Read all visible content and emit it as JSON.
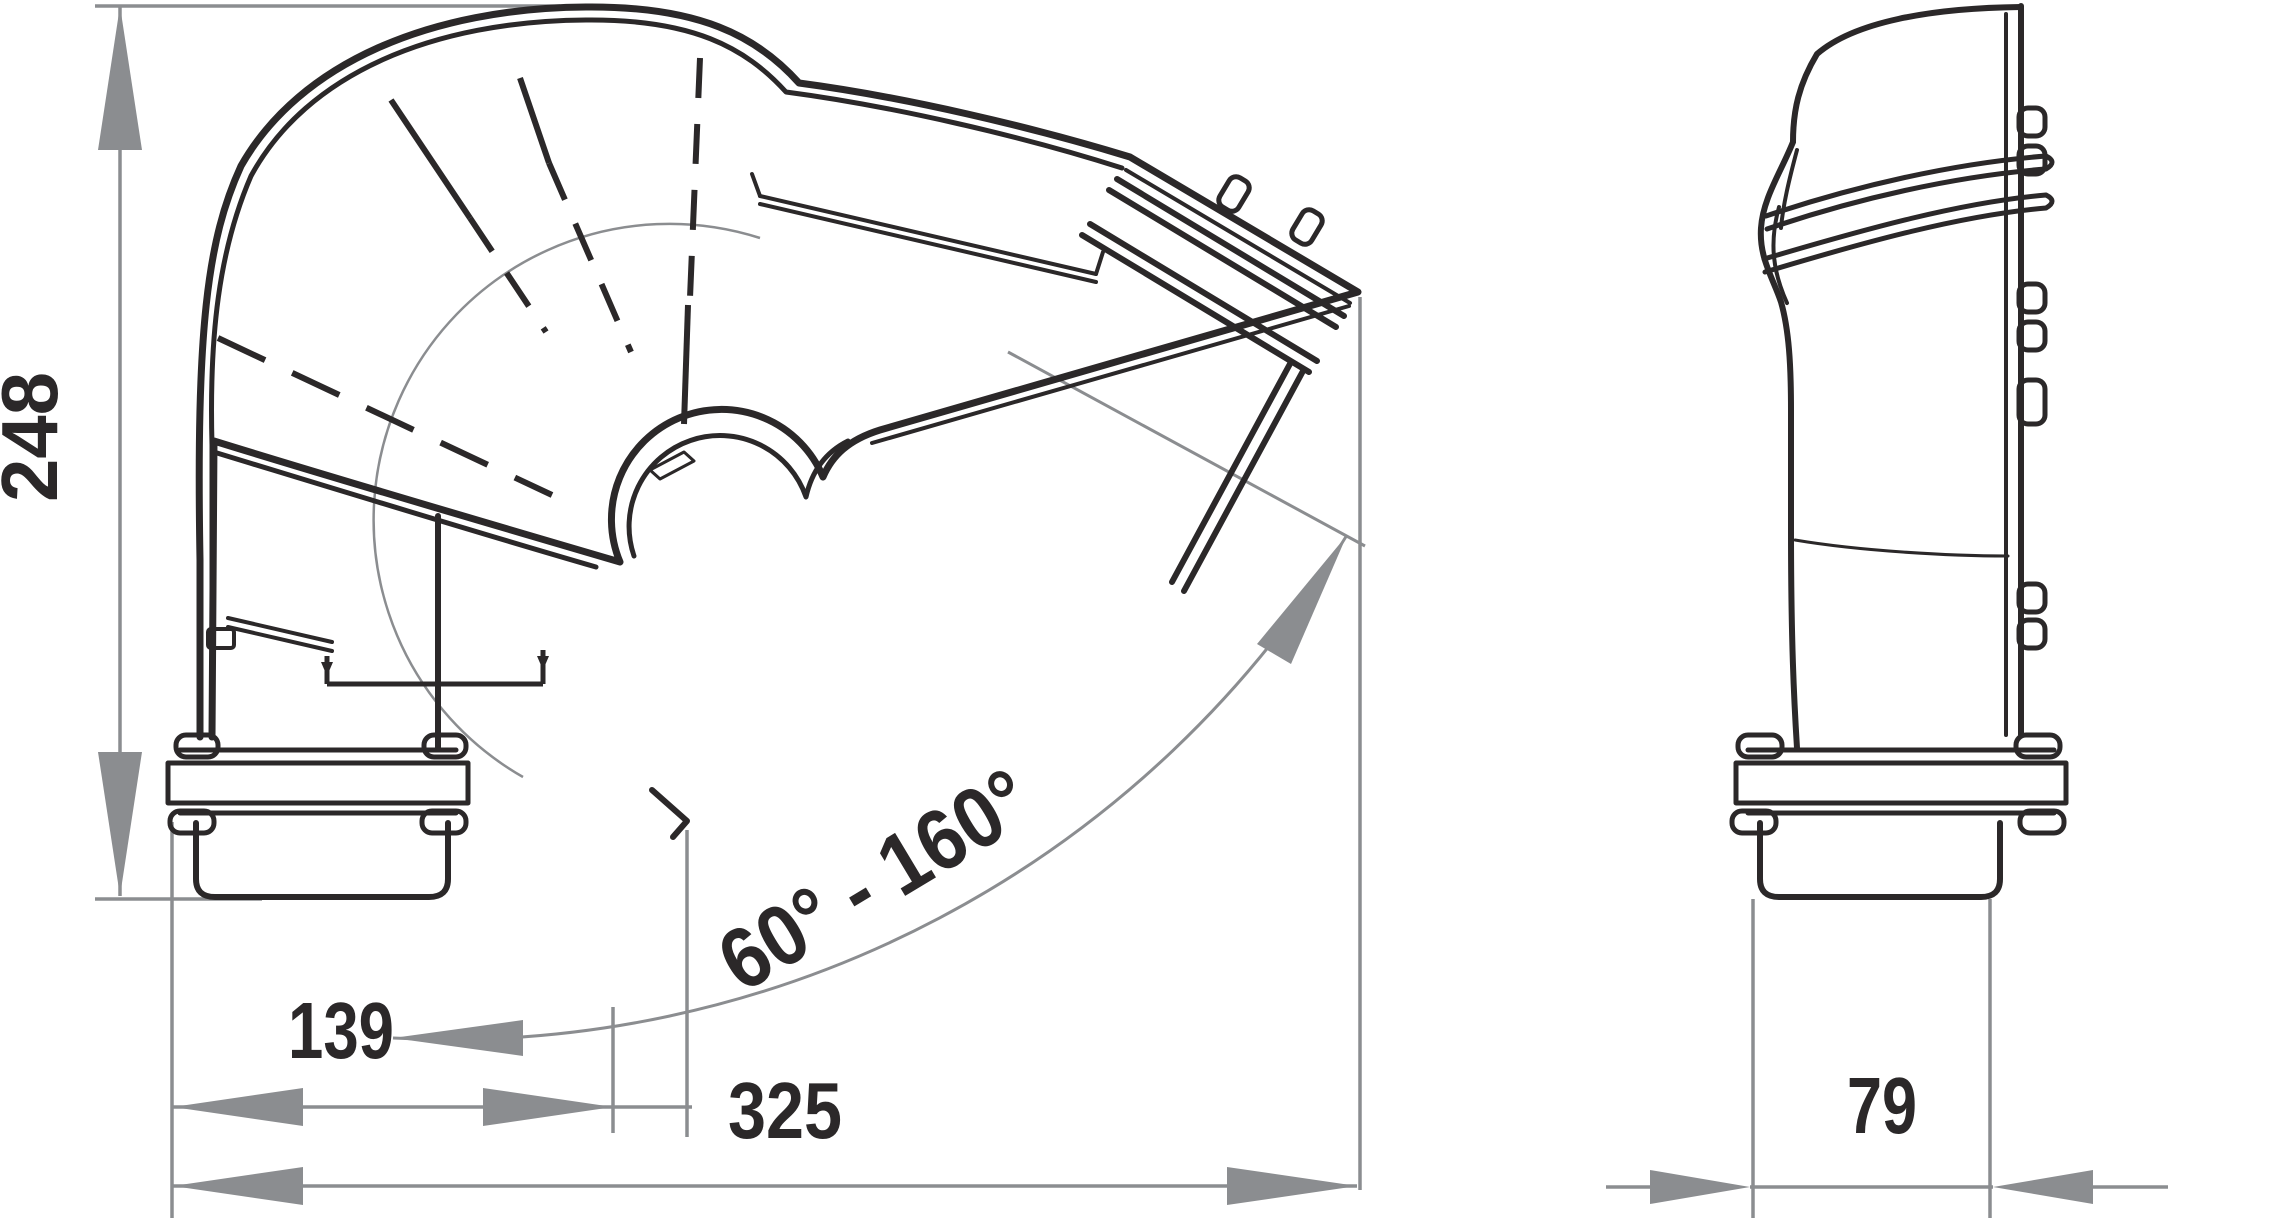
{
  "drawing": {
    "type": "technical-dimension-drawing",
    "subject": "adjustable-duct-elbow",
    "views": [
      "front-view-with-swivel-range",
      "side-view"
    ]
  },
  "colors": {
    "ink": "#2b2829",
    "dimension_gray": "#8b8d90",
    "background": "#ffffff"
  },
  "dimensions": {
    "height": {
      "value": "248",
      "orientation": "vertical"
    },
    "width_inner": {
      "value": "139",
      "orientation": "horizontal"
    },
    "width_overall": {
      "value": "325",
      "orientation": "horizontal"
    },
    "angle_range": {
      "value": "60° - 160°",
      "orientation": "along-arc"
    },
    "depth": {
      "value": "79",
      "orientation": "horizontal"
    }
  }
}
